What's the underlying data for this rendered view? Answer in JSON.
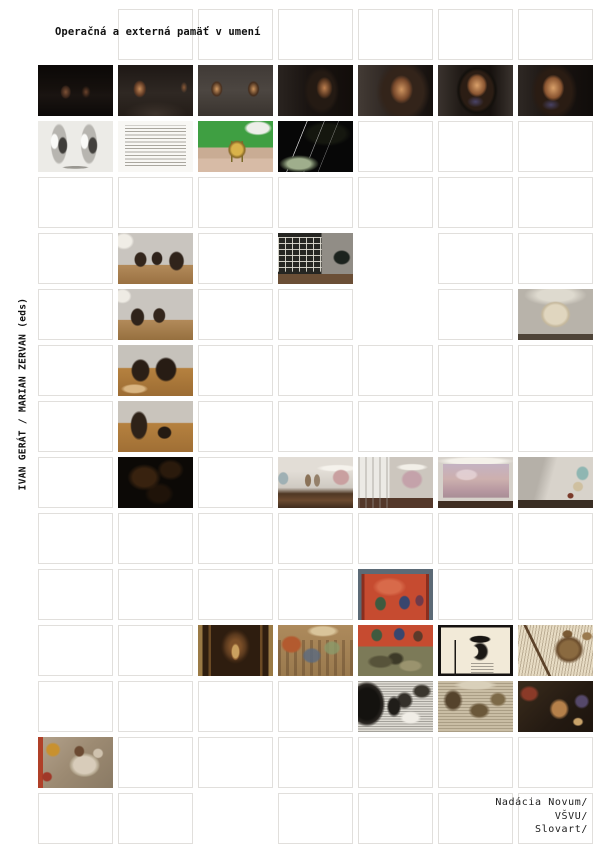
{
  "cover": {
    "title": "Operačná a externá pamäť v umení",
    "editors": "IVAN GERÁT / MARIAN ZERVAN (eds)",
    "publishers": [
      "Nadácia Novum/",
      "VŠVU/",
      "Slovart/"
    ],
    "colors": {
      "background": "#ffffff",
      "cell_border": "#e1dfdc",
      "text": "#111111"
    }
  },
  "grid": {
    "columns": 7,
    "rows": 15,
    "legend": {
      "e": "empty bordered cell",
      "x": "no cell"
    },
    "cells": [
      [
        "x",
        "e",
        "e",
        "e",
        "e",
        "e",
        "e"
      ],
      [
        "seq1",
        "seq2",
        "seq3",
        "seq4",
        "seq5",
        "seq6",
        "seq7"
      ],
      [
        "bwphoto",
        "textpage",
        "greenwall",
        "night",
        "e",
        "e",
        "e"
      ],
      [
        "e",
        "e",
        "e",
        "e",
        "e",
        "e",
        "e"
      ],
      [
        "e",
        "cab1",
        "e",
        "lattice",
        "x",
        "e",
        "e"
      ],
      [
        "e",
        "cab2",
        "e",
        "e",
        "x",
        "e",
        "bookwall"
      ],
      [
        "e",
        "cab3",
        "e",
        "e",
        "e",
        "e",
        "e"
      ],
      [
        "e",
        "cab4",
        "e",
        "e",
        "e",
        "e",
        "e"
      ],
      [
        "e",
        "darkdetail",
        "e",
        "gal1",
        "gal2",
        "gal3",
        "gal4"
      ],
      [
        "e",
        "e",
        "e",
        "e",
        "e",
        "e",
        "e"
      ],
      [
        "e",
        "e",
        "e",
        "e",
        "ms1",
        "e",
        "e"
      ],
      [
        "e",
        "e",
        "altar",
        "fresco1",
        "ms2",
        "woodcut1",
        "woodcut2"
      ],
      [
        "e",
        "e",
        "e",
        "e",
        "engr1",
        "engr2",
        "darkpaint"
      ],
      [
        "fresco2",
        "e",
        "e",
        "e",
        "e",
        "e",
        "e"
      ],
      [
        "e",
        "e",
        "x",
        "e",
        "e",
        "e",
        "e"
      ]
    ],
    "images": {
      "seq1": "dark gallery room with two dimly lit portraits",
      "seq2": "dark gallery with lit portrait on left wall",
      "seq3": "gray gallery wall with two lit portraits",
      "seq4": "dark room with portrait of a man ahead",
      "seq5": "close view of blurred portrait in dark room",
      "seq6": "framed painted portrait of a man, close-up",
      "seq7": "tight crop of painted portrait",
      "bwphoto": "black-and-white photograph with two panels and figures",
      "textpage": "page of dense printed text",
      "greenwall": "green wall and brass apparatus outdoors",
      "night": "night light trails over an illuminated building",
      "cab1": "gallery room with three dark cabinets on parquet floor",
      "lattice": "room with dark lattice grid wall and arch",
      "cab2": "gallery room with two dark cabinets on parquet floor",
      "bookwall": "illuminated book-shaped object on gallery wall",
      "cab3": "two dark cabinets on parquet floor, closer view",
      "cab4": "tall dark cabinet and small object on parquet floor",
      "darkdetail": "very dark close-up of painted cabinet surface",
      "gal1": "gallery room with doorways and rose painting",
      "gal2": "white curtain beside rose painting in gallery",
      "gal3": "large rose-toned painting filling gallery wall",
      "gal4": "gallery corner with collage fragments on wall",
      "ms1": "medieval manuscript, figures on red ground",
      "ms2": "medieval manuscript, red field and green scene",
      "altar": "carved altar niche with gilded figure",
      "fresco1": "medieval fresco with crowd of figures",
      "woodcut1": "woodcut profile of crowned king with scepter",
      "woodcut2": "woodcut of armored figures with sword",
      "engr1": "black-and-white engraving of dense scene",
      "engr2": "sepia engraving with figures in landscape",
      "darkpaint": "dark painting detail with warm figures",
      "fresco2": "fresco fragment with white horse and rider"
    }
  }
}
